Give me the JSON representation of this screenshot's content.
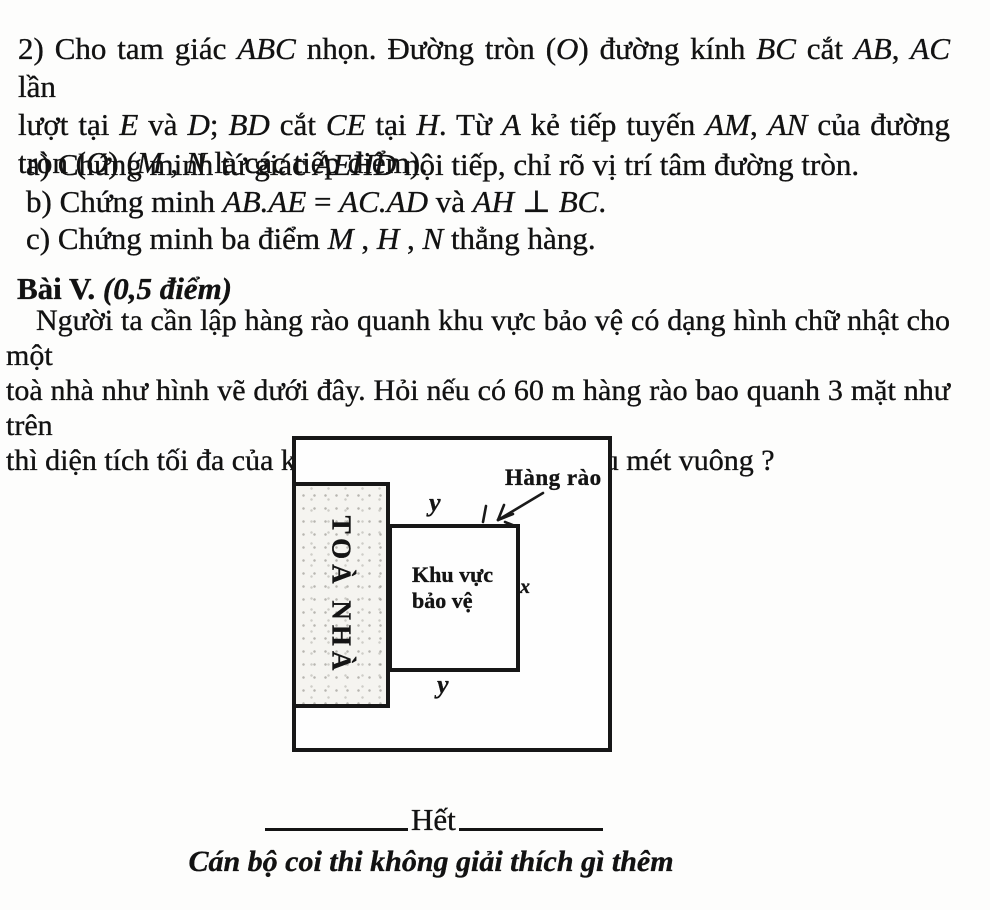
{
  "problem2": {
    "statement": [
      [
        {
          "t": "2) Cho tam giác "
        },
        {
          "t": "ABC",
          "i": 1
        },
        {
          "t": " nhọn. Đường tròn ("
        },
        {
          "t": "O",
          "i": 1
        },
        {
          "t": ") đường kính "
        },
        {
          "t": "BC",
          "i": 1
        },
        {
          "t": " cắt "
        },
        {
          "t": "AB",
          "i": 1
        },
        {
          "t": ", "
        },
        {
          "t": "AC",
          "i": 1
        },
        {
          "t": " lần"
        }
      ],
      [
        {
          "t": "lượt tại "
        },
        {
          "t": "E",
          "i": 1
        },
        {
          "t": " và "
        },
        {
          "t": "D",
          "i": 1
        },
        {
          "t": "; "
        },
        {
          "t": "BD",
          "i": 1
        },
        {
          "t": " cắt "
        },
        {
          "t": "CE",
          "i": 1
        },
        {
          "t": " tại "
        },
        {
          "t": "H",
          "i": 1
        },
        {
          "t": ". Từ "
        },
        {
          "t": "A",
          "i": 1
        },
        {
          "t": " kẻ tiếp tuyến "
        },
        {
          "t": "AM",
          "i": 1
        },
        {
          "t": ", "
        },
        {
          "t": "AN",
          "i": 1
        },
        {
          "t": " của đường"
        }
      ],
      [
        {
          "t": "tròn ("
        },
        {
          "t": "O",
          "i": 1
        },
        {
          "t": ") ("
        },
        {
          "t": "M",
          "i": 1
        },
        {
          "t": " , "
        },
        {
          "t": "N",
          "i": 1
        },
        {
          "t": " là các tiếp điểm)."
        }
      ]
    ],
    "items": [
      [
        {
          "t": "a) Chứng minh tứ giác "
        },
        {
          "t": "AEHD",
          "i": 1
        },
        {
          "t": " nội tiếp, chỉ rõ vị trí tâm đường tròn."
        }
      ],
      [
        {
          "t": "b) Chứng minh "
        },
        {
          "t": "AB.AE",
          "i": 1
        },
        {
          "t": " = "
        },
        {
          "t": "AC.AD",
          "i": 1
        },
        {
          "t": " và "
        },
        {
          "t": "AH",
          "i": 1
        },
        {
          "t": " ⊥ "
        },
        {
          "t": "BC",
          "i": 1
        },
        {
          "t": "."
        }
      ],
      [
        {
          "t": "c) Chứng minh ba điểm "
        },
        {
          "t": "M",
          "i": 1
        },
        {
          "t": " , "
        },
        {
          "t": "H",
          "i": 1
        },
        {
          "t": " , "
        },
        {
          "t": "N",
          "i": 1
        },
        {
          "t": " thẳng hàng."
        }
      ]
    ]
  },
  "section5": {
    "heading_bold": "Bài V.",
    "heading_italic": " (0,5 điểm)",
    "lines": [
      "Người ta cần lập hàng rào quanh khu vực bảo vệ có dạng hình chữ nhật cho một",
      "toà nhà như hình vẽ dưới đây. Hỏi nếu có 60 m hàng rào bao quanh 3 mặt như trên",
      "thì diện tích tối đa của khu vực bảo vệ là bao nhiêu mét vuông ?"
    ]
  },
  "figure": {
    "building_label": "TOÀ NHÀ",
    "area_label_line1": "Khu vực",
    "area_label_line2": "bảo vệ",
    "fence_label": "Hàng rào",
    "dim_top": "y",
    "dim_bottom": "y",
    "dim_right": "x",
    "line_color": "#171717"
  },
  "footer": {
    "end_label": "Hết",
    "note": "Cán bộ coi thi không giải thích gì thêm"
  }
}
